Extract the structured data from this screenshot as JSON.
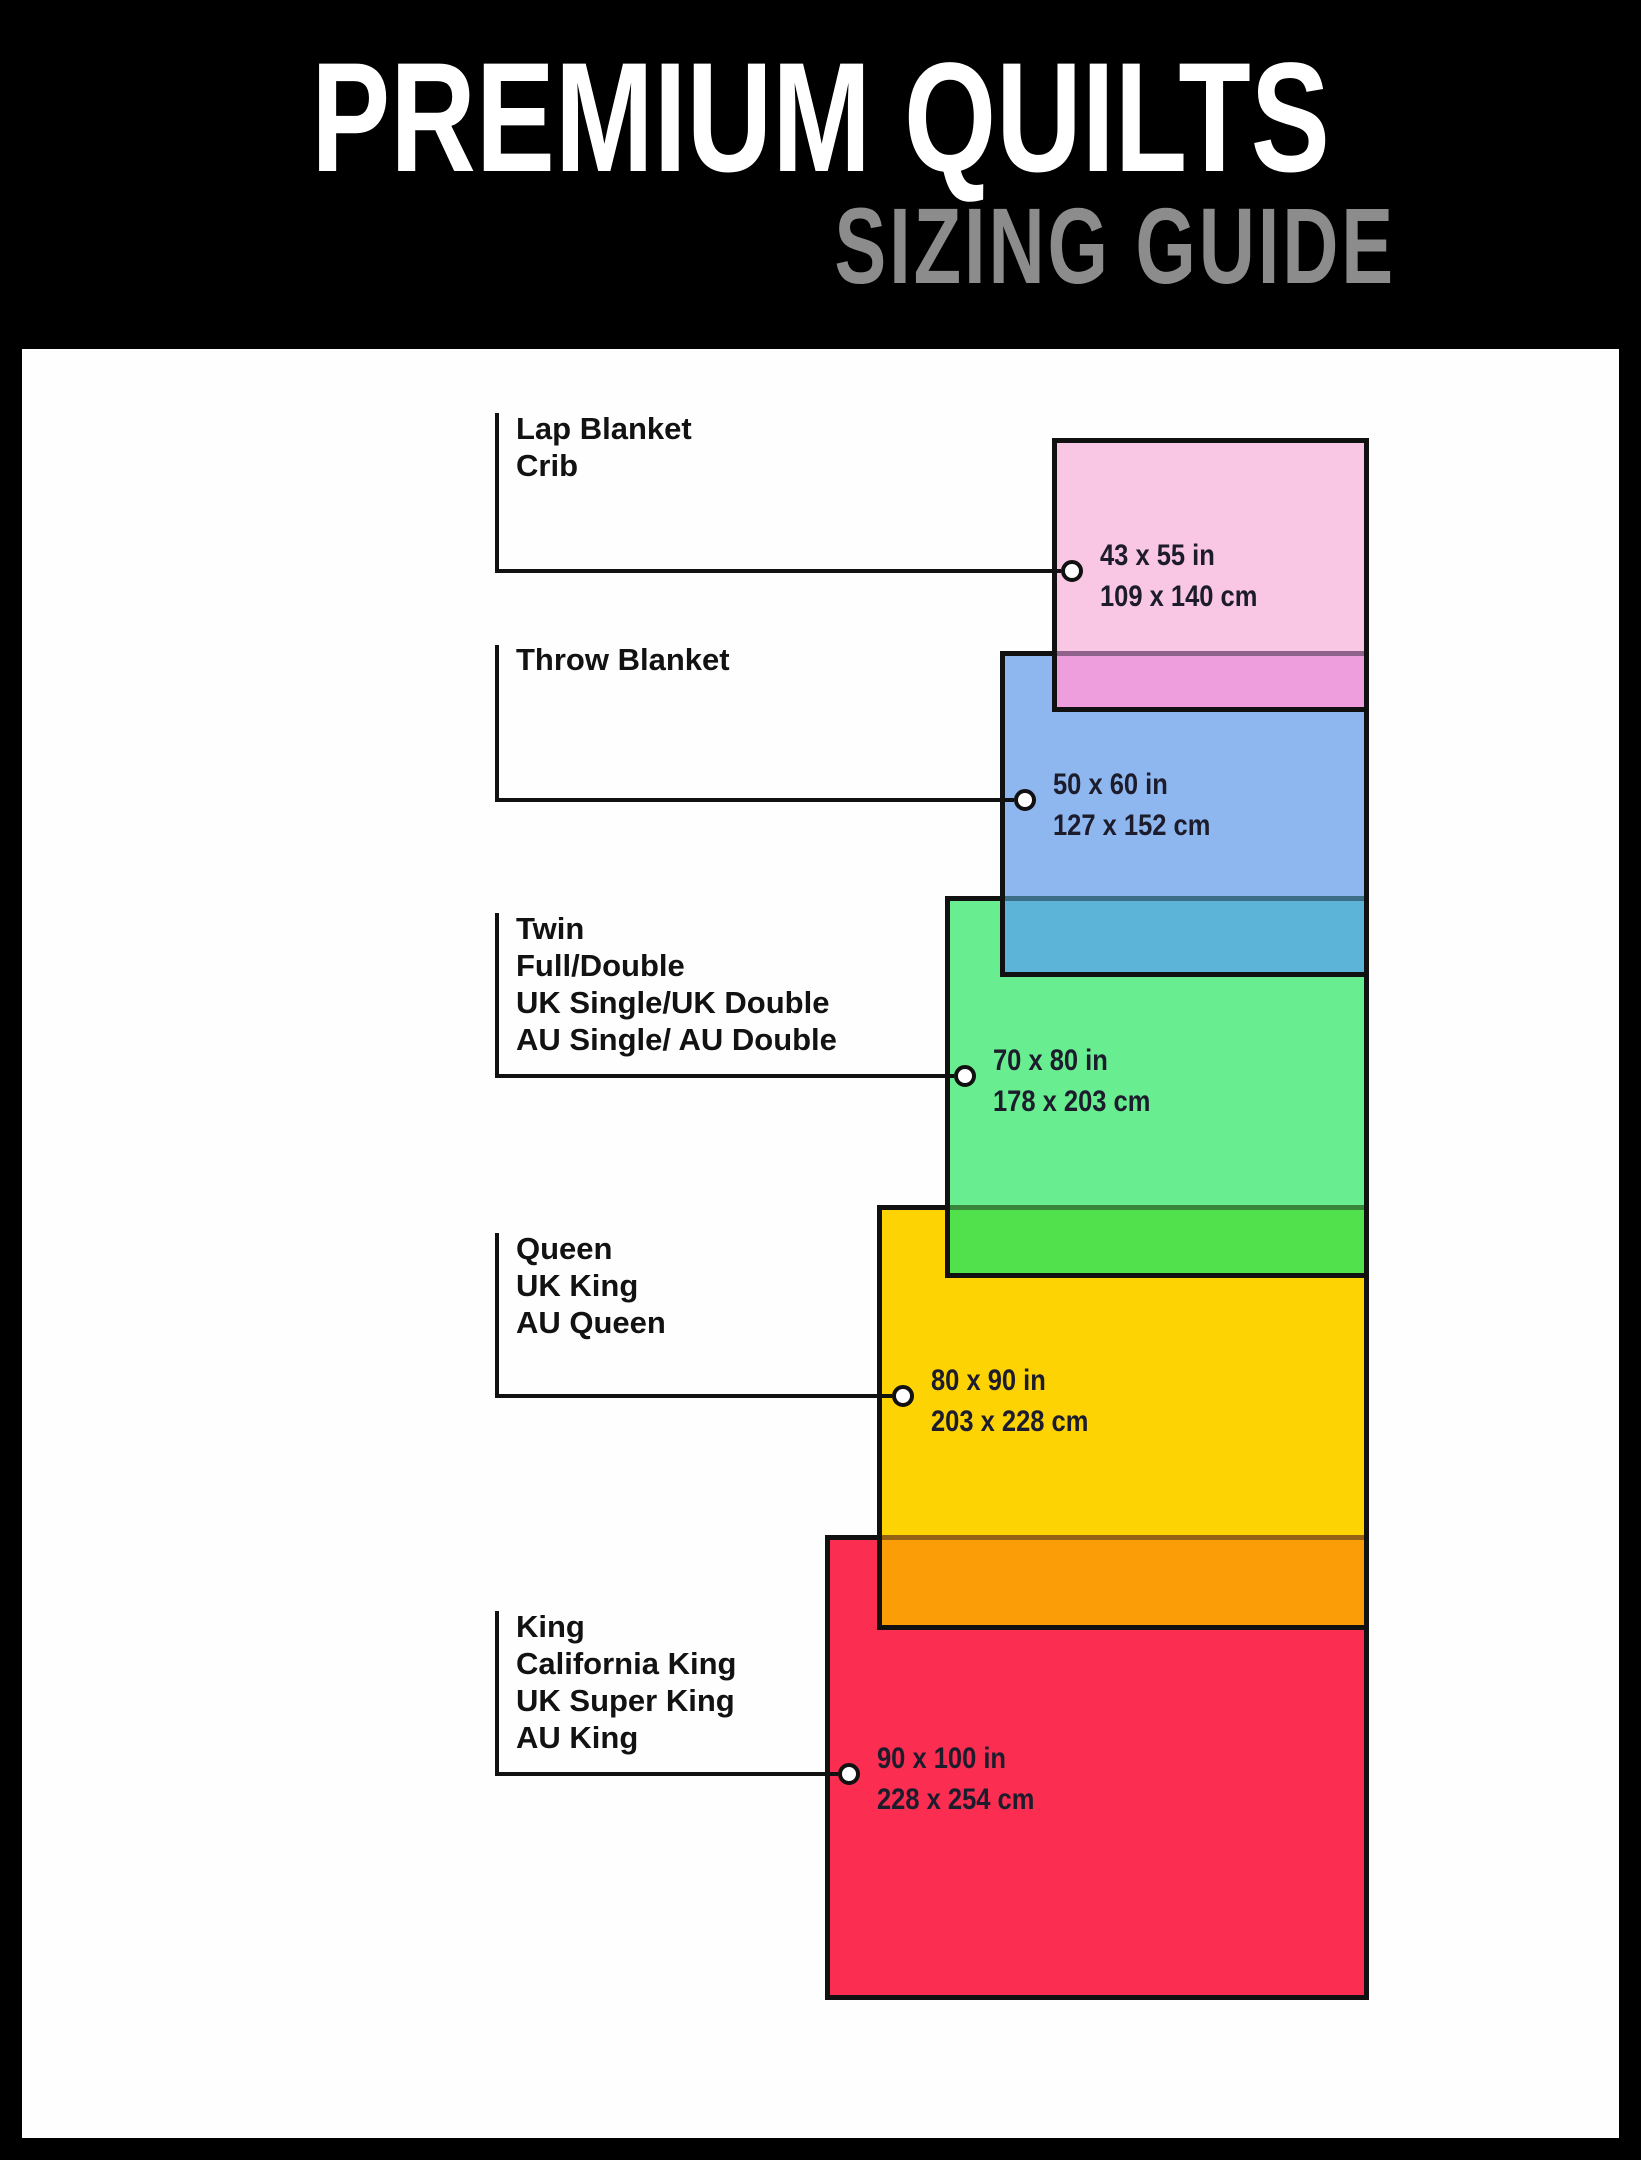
{
  "header": {
    "title": "PREMIUM QUILTS",
    "subtitle": "SIZING GUIDE",
    "title_color": "#ffffff",
    "subtitle_color": "#8c8c8c",
    "background": "#000000"
  },
  "canvas": {
    "background": "#ffffff",
    "line_color": "#111111"
  },
  "sizes": [
    {
      "key": "lap",
      "labels": [
        "Lap Blanket",
        "Crib"
      ],
      "inches": "43 x 55 in",
      "cm": "109 x 140 cm",
      "color": "#f9c6e3",
      "overlap_color": "#ef9edd"
    },
    {
      "key": "throw",
      "labels": [
        "Throw Blanket"
      ],
      "inches": "50 x 60 in",
      "cm": "127 x 152 cm",
      "color": "#8fb7ef",
      "overlap_color": "#5cb5d8"
    },
    {
      "key": "twin",
      "labels": [
        "Twin",
        "Full/Double",
        "UK Single/UK Double",
        "AU Single/ AU Double"
      ],
      "inches": "70 x 80 in",
      "cm": "178 x 203 cm",
      "color": "#68ed90",
      "overlap_color": "#50e14d"
    },
    {
      "key": "queen",
      "labels": [
        "Queen",
        "UK King",
        "AU Queen"
      ],
      "inches": "80 x 90 in",
      "cm": "203 x 228 cm",
      "color": "#fdd303",
      "overlap_color": "#fa9d06"
    },
    {
      "key": "king",
      "labels": [
        "King",
        "California King",
        "UK Super King",
        "AU King"
      ],
      "inches": "90 x 100 in",
      "cm": "228 x 254 cm",
      "color": "#fb2e51",
      "overlap_color": null
    }
  ]
}
